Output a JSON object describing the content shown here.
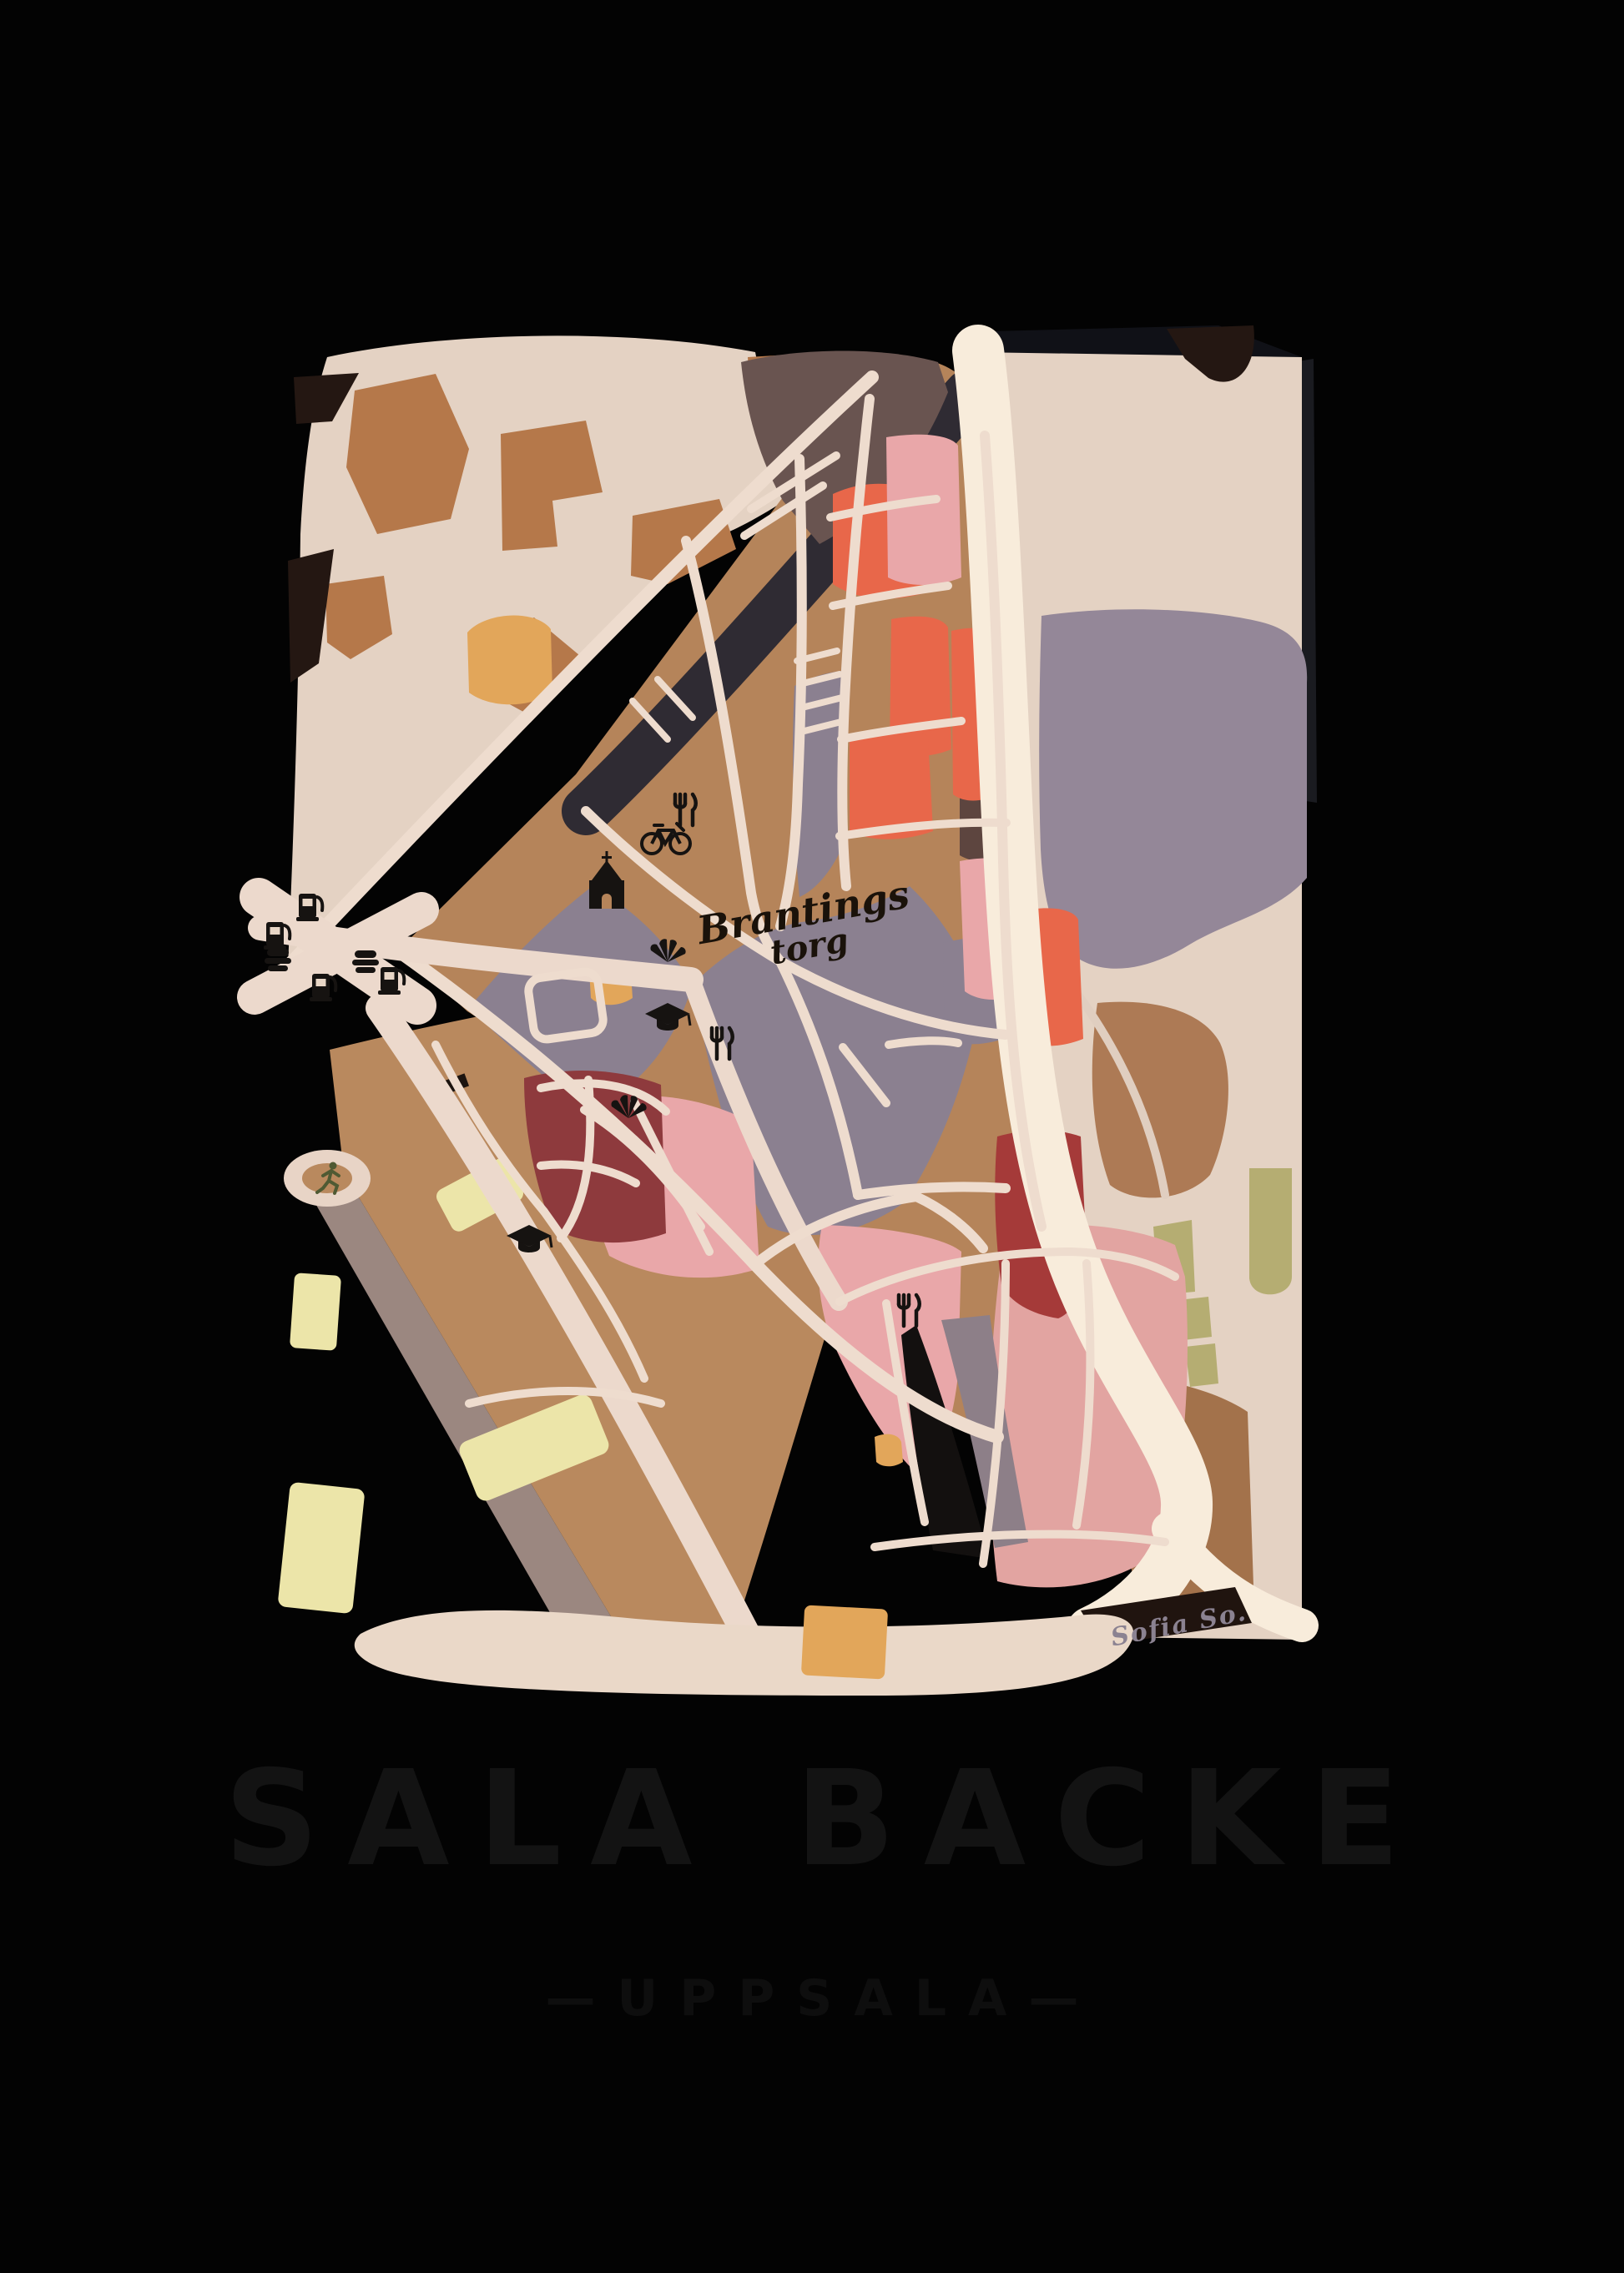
{
  "poster": {
    "title": "SALA BACKE",
    "subtitle": "—UPPSALA—",
    "map_label_line1": "Brantings",
    "map_label_line2": "torg",
    "signature": "Sofia So.",
    "colors": {
      "background": "#030303",
      "paper_beige": "#e4d2c3",
      "street_cream": "#eedcce",
      "main_road_cream": "#f8ecdb",
      "district_tan": "#b5845a",
      "brown_patch": "#b5784a",
      "zone_gray_purple": "#8b8090",
      "right_gray_purple": "#948798",
      "salmon": "#e8674a",
      "pink_light": "#e9a7a9",
      "pink_big": "#e2a4a1",
      "dark_red": "#8e3a3d",
      "bright_red": "#a53a39",
      "dark_brown_block": "#695450",
      "charcoal": "#1a1b20",
      "railway_dark": "#2f2b33",
      "mustard": "#e2a65a",
      "pale_yellow": "#ece5a9",
      "olive": "#b5ad72",
      "shadow_gray": "#9b8780",
      "icon_black": "#161311",
      "runner_green": "#4f5a33",
      "title_ink": "#131313",
      "signature_gray": "#8b8291"
    },
    "icons": [
      {
        "name": "fuel-station-icon",
        "glyph": "⛽"
      },
      {
        "name": "fast-food-icon",
        "glyph": "🍔"
      },
      {
        "name": "church-icon",
        "glyph": "⛪"
      },
      {
        "name": "bicycle-icon",
        "glyph": "🚲"
      },
      {
        "name": "restaurant-icon",
        "glyph": "🍴"
      },
      {
        "name": "school-icon",
        "glyph": "🎓"
      },
      {
        "name": "fountain-icon",
        "glyph": "⛲"
      },
      {
        "name": "running-person-icon",
        "glyph": "🏃"
      }
    ]
  }
}
